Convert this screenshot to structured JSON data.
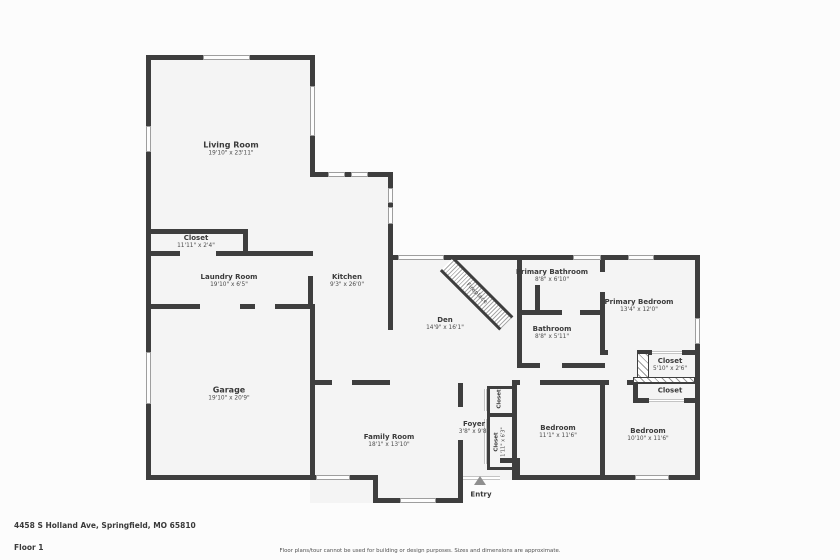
{
  "colors": {
    "wall": "#3e3e3e",
    "room_fill": "#f4f4f4",
    "background": "#fcfcfc",
    "text": "#3a3a3a"
  },
  "rooms": [
    {
      "id": "living-room",
      "name": "Living Room",
      "dims": "19'10\" x 23'11\""
    },
    {
      "id": "hall-closet",
      "name": "Closet",
      "dims": "11'11\" x 2'4\""
    },
    {
      "id": "laundry-room",
      "name": "Laundry Room",
      "dims": "19'10\" x 6'5\""
    },
    {
      "id": "kitchen",
      "name": "Kitchen",
      "dims": "9'3\" x 26'0\""
    },
    {
      "id": "garage",
      "name": "Garage",
      "dims": "19'10\" x 20'9\""
    },
    {
      "id": "den",
      "name": "Den",
      "dims": "14'9\" x 16'1\""
    },
    {
      "id": "fireplace",
      "name": "Fireplace",
      "dims": ""
    },
    {
      "id": "primary-bathroom",
      "name": "Primary Bathroom",
      "dims": "8'8\" x 6'10\""
    },
    {
      "id": "bathroom",
      "name": "Bathroom",
      "dims": "8'8\" x 5'11\""
    },
    {
      "id": "primary-bedroom",
      "name": "Primary Bedroom",
      "dims": "13'4\" x 12'0\""
    },
    {
      "id": "primary-closet",
      "name": "Closet",
      "dims": "5'10\" x 2'6\""
    },
    {
      "id": "bedroom-closet",
      "name": "Closet",
      "dims": ""
    },
    {
      "id": "family-room",
      "name": "Family Room",
      "dims": "18'1\" x 13'10\""
    },
    {
      "id": "foyer",
      "name": "Foyer",
      "dims": "3'8\" x 9'8\""
    },
    {
      "id": "foyer-closet-top",
      "name": "Closet",
      "dims": ""
    },
    {
      "id": "foyer-closet-bottom",
      "name": "Closet",
      "dims": "1'11\" x 6'3\""
    },
    {
      "id": "bedroom-middle",
      "name": "Bedroom",
      "dims": "11'1\" x 11'6\""
    },
    {
      "id": "bedroom-right",
      "name": "Bedroom",
      "dims": "10'10\" x 11'6\""
    },
    {
      "id": "entry",
      "name": "Entry",
      "dims": ""
    }
  ],
  "footer": {
    "address": "4458 S Holland Ave, Springfield, MO 65810",
    "floor_label": "Floor 1",
    "disclaimer": "Floor plans/tour cannot be used for building or design purposes. Sizes and dimensions are approximate."
  }
}
